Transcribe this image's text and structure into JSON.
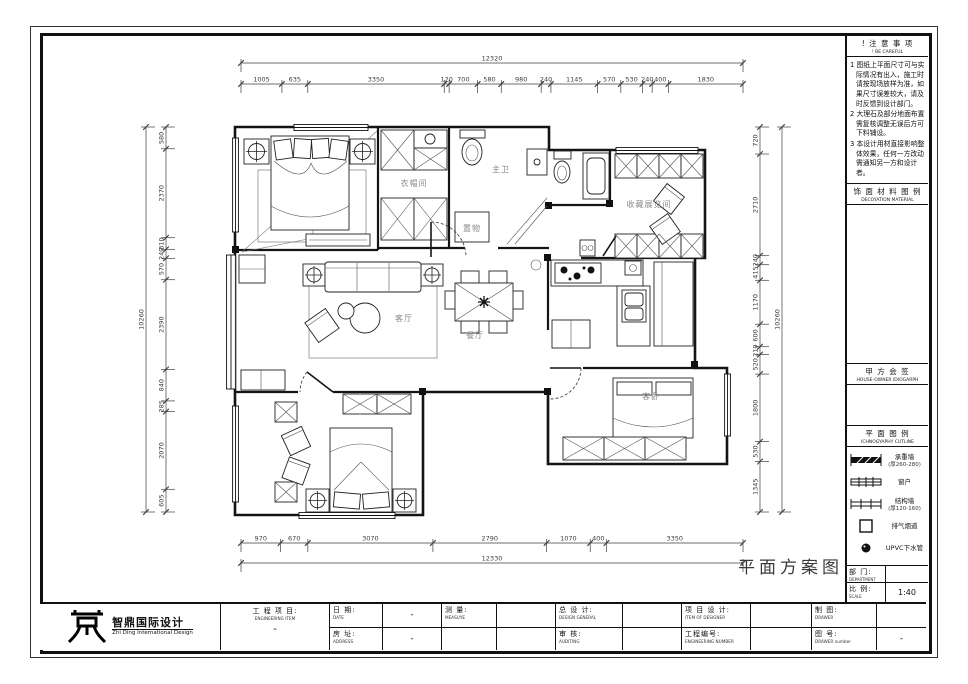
{
  "sheet": {
    "drawing_title": "平面方案图"
  },
  "logo": {
    "cn": "智鼎国际设计",
    "en": "Zhi Ding International Design"
  },
  "sidebar": {
    "notice": {
      "title_cn": "! 注 意 事 项",
      "title_en": "! BE CAREFUL",
      "notes": [
        "1 图纸上平面尺寸可与实际情况有出入，施工时请按现场放样为准，如果尺寸误差较大，请及时反馈到设计部门。",
        "2 大理石及部分地面布置需复核调整无误后方可下料铺设。",
        "3 本设计用材直接影响整体效果，任何一方改动需通知另一方和设计者。"
      ]
    },
    "material_legend": {
      "title_cn": "饰 面 材 料 图 例",
      "title_en": "DECOYATION MATERIAL"
    },
    "owner_sign": {
      "title_cn": "甲 方 会 签",
      "title_en": "HOUSE-OWNER IDIOGARPH"
    },
    "plan_legend": {
      "title_cn": "平 面 图 例",
      "title_en": "ICHNOGYAPHY CUTLINE",
      "items": [
        {
          "name": "承重墙",
          "sub": "(厚260-280)",
          "symbol": "bearing-wall"
        },
        {
          "name": "窗户",
          "sub": "",
          "symbol": "window"
        },
        {
          "name": "结构墙",
          "sub": "(厚120-160)",
          "symbol": "structure-wall"
        },
        {
          "name": "排气烟道",
          "sub": "",
          "symbol": "exhaust-flue"
        },
        {
          "name": "UPVC下水管",
          "sub": "",
          "symbol": "upvc-pipe"
        }
      ]
    },
    "department": {
      "label_cn": "部 门:",
      "label_en": "DEPARTMENT",
      "value": ""
    },
    "scale": {
      "label_cn": "比 例:",
      "label_en": "SCALE",
      "value": "1:40"
    }
  },
  "titleblock": {
    "fields": [
      {
        "cn": "工 程 项 目:",
        "en": "ENGINEERING ITEM",
        "value": "-"
      },
      {
        "cn": "日  期:",
        "en": "DATE",
        "value": "-"
      },
      {
        "cn": "房  址:",
        "en": "ADDRESS",
        "value": "-"
      },
      {
        "cn": "测  量:",
        "en": "MEASUYE",
        "value": ""
      },
      {
        "cn": "总 设 计:",
        "en": "DESIGN GENERAL",
        "value": ""
      },
      {
        "cn": "审  核:",
        "en": "AUDITING",
        "value": ""
      },
      {
        "cn": "项 目 设 计:",
        "en": "ITEM OF DESIGNER",
        "value": ""
      },
      {
        "cn": "工程编号:",
        "en": "ENGINEERING NUMBER",
        "value": ""
      },
      {
        "cn": "制  图:",
        "en": "DRAWER",
        "value": ""
      },
      {
        "cn": "图  号:",
        "en": "DRAWER number",
        "value": "-"
      }
    ]
  },
  "plan": {
    "rooms": {
      "cloakroom": "衣帽间",
      "master_bath": "主卫",
      "storage": "置物",
      "collection": "收藏展览间",
      "living": "客厅",
      "dining": "餐厅",
      "guest": "客卧"
    }
  },
  "dimensions": {
    "top": {
      "total": "12320",
      "segments": [
        "1005",
        "635",
        "3350",
        "120",
        "700",
        "580",
        "980",
        "240",
        "1145",
        "570",
        "530",
        "240",
        "400",
        "1830"
      ]
    },
    "bottom": {
      "total": "12330",
      "segments": [
        "970",
        "670",
        "3070",
        "2790",
        "1070",
        "400",
        "3350"
      ]
    },
    "left": {
      "total": "10260",
      "segments": [
        "580",
        "2370",
        "310",
        "240",
        "570",
        "2390",
        "840",
        "285",
        "2070",
        "605"
      ]
    },
    "right": {
      "total": "10260",
      "segments": [
        "720",
        "2710",
        "240",
        "415",
        "1170",
        "600",
        "210",
        "520",
        "1800",
        "530",
        "1345"
      ]
    }
  }
}
